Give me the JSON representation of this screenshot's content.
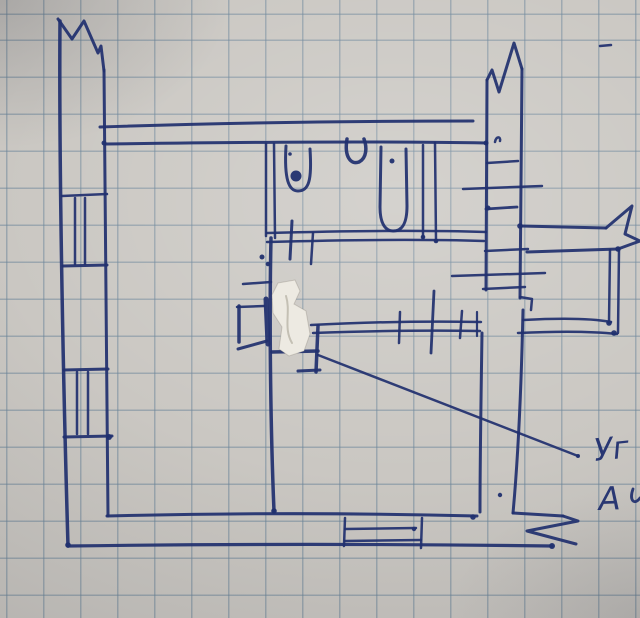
{
  "sketch": {
    "kind": "hand-drawn floor plan",
    "ink_color": "#21306f",
    "paper_color": "#cac7c2",
    "grid_color": "rgba(105,132,152,0.5)",
    "whiteout_color": "#edeae2",
    "annotation": {
      "line1": "Уг",
      "line2": "А"
    },
    "whiteout": {
      "points": "278,283 295,280 300,291 294,304 306,311 310,334 304,351 289,356 279,349 282,327 273,313 272,295",
      "scribble": "M286,296 C291,312 283,328 292,343"
    },
    "strokes": [
      {
        "n": "break-mark-top-left",
        "d": "M58,19 L72,39 L84,21 L98,53 L101,46 L104,71",
        "w": 3
      },
      {
        "n": "wall-outer-left",
        "d": "M60,21 C59,140 62,340 68,546",
        "w": 3.5
      },
      {
        "n": "wall-inner-left",
        "d": "M104,70 C106,200 106,380 108,516",
        "w": 3
      },
      {
        "n": "wall-top-outer",
        "d": "M100,127 C220,123 360,121 473,121",
        "w": 3
      },
      {
        "n": "wall-top-inner",
        "d": "M106,144 C250,142 380,141 486,143",
        "w": 3
      },
      {
        "n": "window-left-upper",
        "d": "M62,196 L107,194",
        "w": 2.5
      },
      {
        "n": "window-left-upper",
        "d": "M75,198 L75,264",
        "w": 2.5
      },
      {
        "n": "window-left-upper",
        "d": "M85,198 L85,264",
        "w": 2.5
      },
      {
        "n": "window-left-upper",
        "d": "M63,266 L107,265",
        "w": 3
      },
      {
        "n": "window-left-lower",
        "d": "M64,370 L108,369",
        "w": 3
      },
      {
        "n": "window-left-lower",
        "d": "M77,372 L77,434",
        "w": 2.5
      },
      {
        "n": "window-left-lower",
        "d": "M88,372 L88,434",
        "w": 2.5
      },
      {
        "n": "window-left-lower",
        "d": "M64,437 L112,436",
        "w": 3
      },
      {
        "n": "wall-bottom-inner",
        "d": "M107,516 C230,513 360,513 477,516",
        "w": 3
      },
      {
        "n": "wall-bottom-outer",
        "d": "M68,546 C220,544 400,544 552,546",
        "w": 3.2
      },
      {
        "n": "window-bottom",
        "d": "M345,518 L344,546",
        "w": 2.5
      },
      {
        "n": "window-bottom",
        "d": "M422,518 L421,548",
        "w": 2.5
      },
      {
        "n": "window-bottom",
        "d": "M345,529 L416,528",
        "w": 2.5
      },
      {
        "n": "window-bottom",
        "d": "M345,541 L421,540",
        "w": 2.5
      },
      {
        "n": "wall-bathroom-left",
        "d": "M266,144 L266,236",
        "w": 2.5
      },
      {
        "n": "wall-bathroom-left",
        "d": "M274,144 L275,238",
        "w": 2.5
      },
      {
        "n": "toilet",
        "d": "M286,146 C284,180 289,191 298,191 C309,191 312,180 310,149",
        "w": 3
      },
      {
        "n": "sink",
        "d": "M347,139 C344,157 351,165 359,162 C367,158 367,147 364,139",
        "w": 3.5
      },
      {
        "n": "bathtub",
        "d": "M381,147 L380,207 C380,226 387,231 393,231 C402,231 407,224 407,206 L406,149",
        "w": 3
      },
      {
        "n": "wall-bathroom-right",
        "d": "M423,145 L423,238",
        "w": 2.5
      },
      {
        "n": "wall-bathroom-right",
        "d": "M435,143 L436,241",
        "w": 2.5
      },
      {
        "n": "wall-bathroom-bottom",
        "d": "M267,233 C340,231 420,230 486,232",
        "w": 2.5
      },
      {
        "n": "wall-bathroom-bottom",
        "d": "M267,242 C340,240 420,239 484,241",
        "w": 2.5
      },
      {
        "n": "door-mark",
        "d": "M292,221 L290,259",
        "w": 3
      },
      {
        "n": "wall-tick",
        "d": "M313,233 L311,264",
        "w": 2.5
      },
      {
        "n": "ink-mark",
        "d": "M495,142 C496,136 501,136 500,141",
        "w": 2.5
      },
      {
        "n": "wall-center-vertical",
        "d": "M271,238 C269,330 271,440 274,511",
        "w": 3.5
      },
      {
        "n": "wall-tick",
        "d": "M243,284 L271,282",
        "w": 2.5
      },
      {
        "n": "fixture-box",
        "d": "M237,307 L264,306",
        "w": 2.5
      },
      {
        "n": "fixture-box",
        "d": "M239,306 L239,342",
        "w": 3.5
      },
      {
        "n": "fixture-box",
        "d": "M238,349 L267,341",
        "w": 3
      },
      {
        "n": "fixture-box",
        "d": "M266,299 L268,344",
        "w": 5
      },
      {
        "n": "wall-notch",
        "d": "M272,352 L318,351",
        "w": 3.5
      },
      {
        "n": "wall-notch",
        "d": "M318,326 L316,372",
        "w": 3.5
      },
      {
        "n": "wall-notch",
        "d": "M298,371 L320,370",
        "w": 3
      },
      {
        "n": "partition-wall",
        "d": "M311,325 C370,322 430,321 481,322",
        "w": 2.5
      },
      {
        "n": "partition-wall",
        "d": "M313,333 C370,331 430,330 480,331",
        "w": 2.5
      },
      {
        "n": "partition-tick",
        "d": "M400,312 L399,343",
        "w": 2.5
      },
      {
        "n": "partition-tick",
        "d": "M434,291 L431,353",
        "w": 2.8
      },
      {
        "n": "partition-tick",
        "d": "M462,311 L460,338",
        "w": 2.5
      },
      {
        "n": "partition-tick",
        "d": "M477,312 L477,336",
        "w": 2.2
      },
      {
        "n": "break-mark-top-right",
        "d": "M487,80 L492,70 L499,92 L514,43 L522,69",
        "w": 3
      },
      {
        "n": "wall-inner-right",
        "d": "M487,80 L486,290",
        "w": 3
      },
      {
        "n": "wall-outer-right",
        "d": "M522,69 L520,298",
        "w": 3
      },
      {
        "n": "radiator-tick",
        "d": "M487,163 L518,161",
        "w": 2.5
      },
      {
        "n": "radiator-tick",
        "d": "M463,189 L542,186",
        "w": 2.5
      },
      {
        "n": "radiator-tick",
        "d": "M486,209 L517,207",
        "w": 2.8
      },
      {
        "n": "radiator-tick",
        "d": "M485,251 L528,249",
        "w": 2.5
      },
      {
        "n": "radiator-tick",
        "d": "M452,276 L545,273",
        "w": 2.5
      },
      {
        "n": "radiator-tick",
        "d": "M483,289 L525,287",
        "w": 2.5
      },
      {
        "n": "ink-dash",
        "d": "M600,46 L611,45",
        "w": 2.5
      },
      {
        "n": "wall-jog",
        "d": "M521,226 L606,228",
        "w": 3
      },
      {
        "n": "break-mark-corner",
        "d": "M606,228 L632,206 L625,234 L640,241 L618,249",
        "w": 3
      },
      {
        "n": "annex-top",
        "d": "M618,249 C580,250 550,251 527,252",
        "w": 3
      },
      {
        "n": "wall-step",
        "d": "M520,297 L532,299 L531,310",
        "w": 2.5
      },
      {
        "n": "wall-outer-right-lower",
        "d": "M523,310 C521,400 517,470 513,513",
        "w": 3
      },
      {
        "n": "wall-bottom-step",
        "d": "M513,513 L563,516",
        "w": 3
      },
      {
        "n": "break-mark-bottom-right",
        "d": "M563,516 L578,521 L527,531 L576,544",
        "w": 3
      },
      {
        "n": "wall-inner-right-lower",
        "d": "M482,333 C481,400 480,460 480,512",
        "w": 3
      },
      {
        "n": "annex-bottom",
        "d": "M523,320 C560,318 590,318 611,322",
        "w": 2.5
      },
      {
        "n": "annex-bottom",
        "d": "M518,333 C560,331 590,331 617,334",
        "w": 2.5
      },
      {
        "n": "annex-right",
        "d": "M610,250 L609,323",
        "w": 2.5
      },
      {
        "n": "annex-right",
        "d": "M619,250 L618,333",
        "w": 2.5
      },
      {
        "n": "leader-line",
        "d": "M318,355 L578,456",
        "w": 2.5
      },
      {
        "n": "partial-letter",
        "d": "M633,489 C629,500 634,506 640,498",
        "w": 2.8
      }
    ],
    "dots": [
      [
        104,
        143,
        2.5
      ],
      [
        486,
        143,
        2.5
      ],
      [
        290,
        154,
        1.8
      ],
      [
        392,
        161,
        2.5
      ],
      [
        296,
        176,
        5.5
      ],
      [
        262,
        257,
        2.5
      ],
      [
        268,
        264,
        2.3
      ],
      [
        274,
        511,
        2.8
      ],
      [
        473,
        517,
        2.8
      ],
      [
        68,
        545,
        2.8
      ],
      [
        552,
        546,
        3
      ],
      [
        414,
        529,
        2.2
      ],
      [
        109,
        437,
        3
      ],
      [
        488,
        208,
        2.5
      ],
      [
        520,
        226,
        2.8
      ],
      [
        618,
        249,
        2.8
      ],
      [
        609,
        323,
        2.8
      ],
      [
        614,
        333,
        2.8
      ],
      [
        500,
        495,
        2.2
      ],
      [
        578,
        456,
        2
      ],
      [
        423,
        237,
        2.3
      ],
      [
        436,
        241,
        2.3
      ]
    ]
  }
}
